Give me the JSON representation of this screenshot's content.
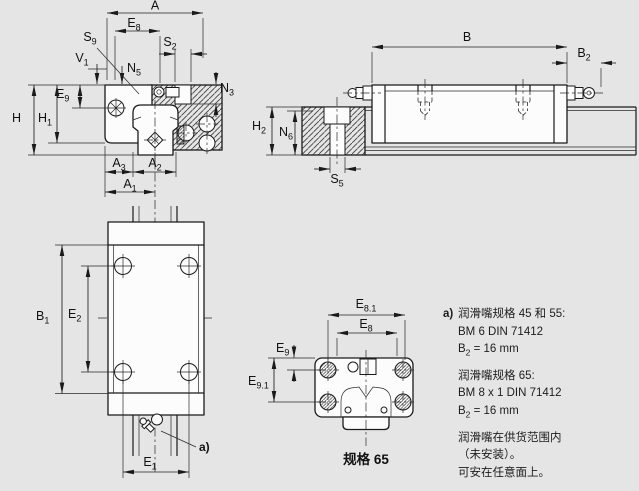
{
  "colors": {
    "background": "#e5e5e5",
    "line": "#1a1a1a",
    "part_fill": "#fcfcfc"
  },
  "views": {
    "front_section": {
      "labels": {
        "A": {
          "base": "A",
          "sub": ""
        },
        "E8": {
          "base": "E",
          "sub": "8"
        },
        "S2": {
          "base": "S",
          "sub": "2"
        },
        "S9": {
          "base": "S",
          "sub": "9"
        },
        "V1": {
          "base": "V",
          "sub": "1"
        },
        "N5": {
          "base": "N",
          "sub": "5"
        },
        "N3": {
          "base": "N",
          "sub": "3"
        },
        "E9": {
          "base": "E",
          "sub": "9"
        },
        "H": {
          "base": "H",
          "sub": ""
        },
        "H1": {
          "base": "H",
          "sub": "1"
        },
        "A3": {
          "base": "A",
          "sub": "3"
        },
        "A2": {
          "base": "A",
          "sub": "2"
        },
        "A1": {
          "base": "A",
          "sub": "1"
        }
      }
    },
    "side": {
      "labels": {
        "B": {
          "base": "B",
          "sub": ""
        },
        "B2": {
          "base": "B",
          "sub": "2"
        },
        "H2": {
          "base": "H",
          "sub": "2"
        },
        "N6": {
          "base": "N",
          "sub": "6"
        },
        "S5": {
          "base": "S",
          "sub": "5"
        }
      }
    },
    "plan": {
      "labels": {
        "B1": {
          "base": "B",
          "sub": "1"
        },
        "E2": {
          "base": "E",
          "sub": "2"
        },
        "E1": {
          "base": "E",
          "sub": "1"
        },
        "note_ref": "a)"
      }
    },
    "end_view": {
      "caption": "规格 65",
      "labels": {
        "E81": {
          "base": "E",
          "sub": "8.1"
        },
        "E8": {
          "base": "E",
          "sub": "8"
        },
        "E9": {
          "base": "E",
          "sub": "9"
        },
        "E91": {
          "base": "E",
          "sub": "9.1"
        }
      }
    }
  },
  "note": {
    "marker": "a)",
    "groups": [
      {
        "lines": [
          {
            "text": "润滑嘴规格 45 和 55:"
          },
          {
            "text": "BM 6 DIN 71412"
          },
          {
            "pre": "B",
            "sub": "2",
            "post": " = 16 mm"
          }
        ]
      },
      {
        "lines": [
          {
            "text": "润滑嘴规格 65:"
          },
          {
            "text": "BM 8 x 1 DIN 71412"
          },
          {
            "pre": "B",
            "sub": "2",
            "post": " = 16 mm"
          }
        ]
      },
      {
        "lines": [
          {
            "text": "润滑嘴在供货范围内"
          },
          {
            "text": "（未安装）。"
          },
          {
            "text": "可安在任意面上。"
          }
        ]
      }
    ]
  }
}
